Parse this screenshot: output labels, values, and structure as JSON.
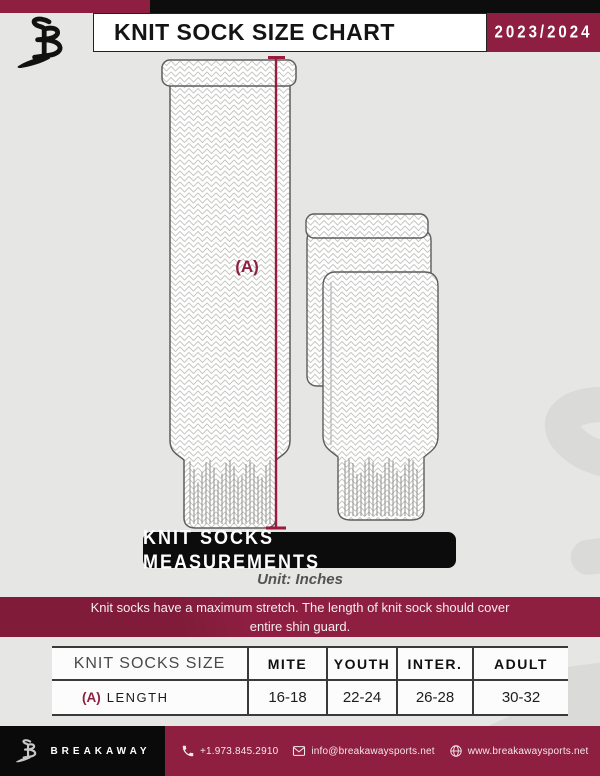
{
  "colors": {
    "maroon": "#8e1f40",
    "black": "#0d0d0d",
    "page_bg": "#e6e6e4",
    "table_line": "#3a3a3a",
    "measure_line": "#9b1b3c"
  },
  "header": {
    "title": "KNIT SOCK SIZE CHART",
    "season": "2023/2024"
  },
  "diagram": {
    "measurement_label": "(A)",
    "banner_title": "KNIT SOCKS MEASUREMENTS",
    "unit_note": "Unit: Inches"
  },
  "notice": {
    "line1": "Knit socks have a maximum stretch. The length of knit sock should cover",
    "line2": "entire shin guard."
  },
  "size_table": {
    "columns": [
      "KNIT SOCKS SIZE",
      "MITE",
      "YOUTH",
      "INTER.",
      "ADULT"
    ],
    "rows": [
      {
        "key": "(A)",
        "label": "LENGTH",
        "values": [
          "16-18",
          "22-24",
          "26-28",
          "30-32"
        ]
      }
    ]
  },
  "footer": {
    "brand": "BREAKAWAY",
    "phone": "+1.973.845.2910",
    "email": "info@breakawaysports.net",
    "website": "www.breakawaysports.net"
  },
  "icons": {
    "brand": "breakaway-monogram",
    "watermark": "breakaway-monogram-watermark",
    "phone": "phone-icon",
    "email": "envelope-icon",
    "website": "globe-icon"
  }
}
